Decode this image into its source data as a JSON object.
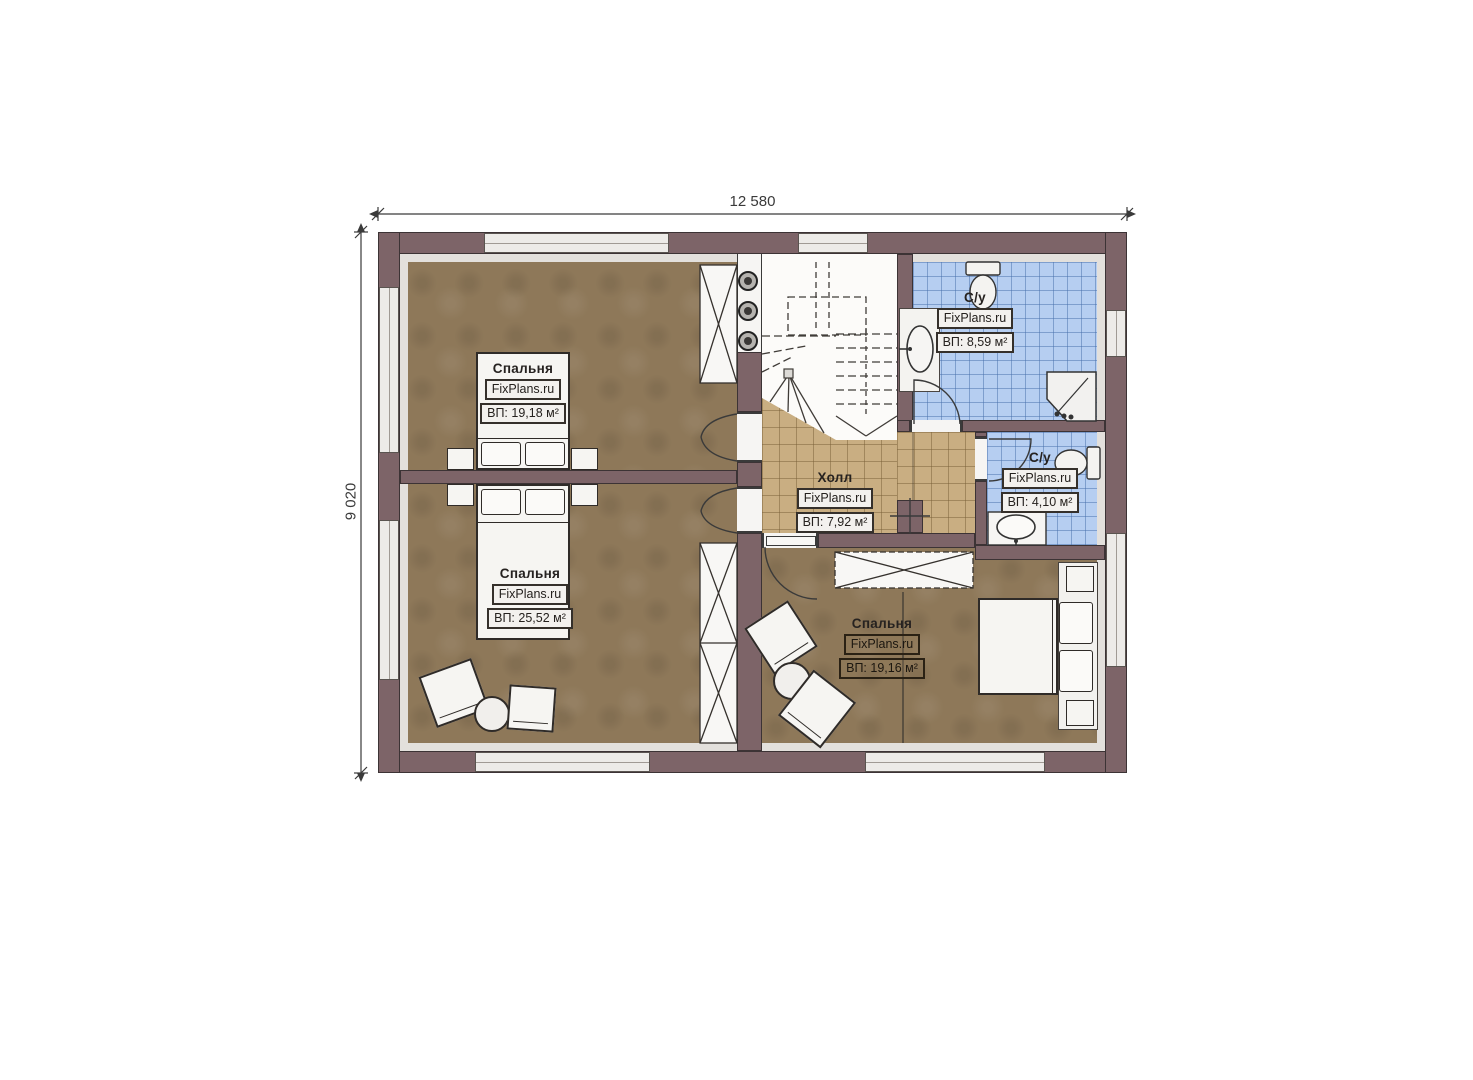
{
  "dimensions": {
    "width_label": "12 580",
    "height_label": "9 020"
  },
  "rooms": {
    "bedroom_top_left": {
      "title": "Спальня",
      "brand": "FixPlans.ru",
      "area": "ВП: 19,18 м²"
    },
    "bedroom_bottom_left": {
      "title": "Спальня",
      "brand": "FixPlans.ru",
      "area": "ВП: 25,52 м²"
    },
    "bedroom_right": {
      "title": "Спальня",
      "brand": "FixPlans.ru",
      "area": "ВП: 19,16 м²"
    },
    "hall": {
      "title": "Холл",
      "brand": "FixPlans.ru",
      "area": "ВП: 7,92 м²"
    },
    "bathroom_top": {
      "title": "С/у",
      "brand": "FixPlans.ru",
      "area": "ВП: 8,59 м²"
    },
    "bathroom_small": {
      "title": "С/у",
      "brand": "FixPlans.ru",
      "area": "ВП: 4,10 м²"
    }
  },
  "colors": {
    "wall": "#7d6468",
    "bedroom_floor": "#8e7859",
    "hall_floor": "#c9ae82",
    "bathroom_floor": "#b6cef1"
  }
}
